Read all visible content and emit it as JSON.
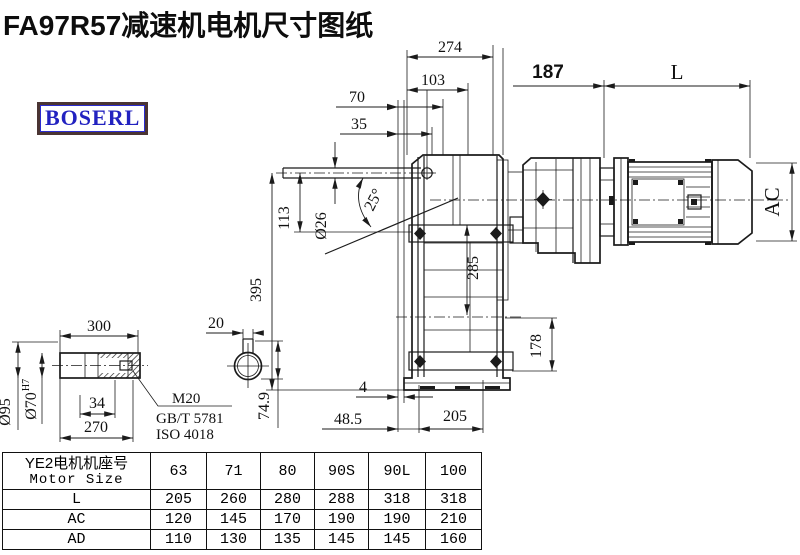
{
  "title": "FA97R57减速机电机尺寸图纸",
  "logo": {
    "text": "BOSERL",
    "text_color": "#2222c0",
    "border_outer": "#4a3433",
    "border_inner": "#2b2bd0"
  },
  "drawing": {
    "line_color": "#1b1b1b",
    "dims": {
      "d274": "274",
      "d103": "103",
      "d70": "70",
      "d35": "35",
      "d187": "187",
      "dL": "L",
      "angle25": "25°",
      "dia26": "Ø26",
      "d113": "113",
      "d395": "395",
      "d285": "285",
      "d178": "178",
      "dAC": "AC",
      "d4": "4",
      "d48_5": "48.5",
      "d205": "205",
      "d300": "300",
      "d20": "20",
      "dia95": "Ø95",
      "dia70": "Ø70",
      "tol70": "H7",
      "d34": "34",
      "d270": "270",
      "d74_9": "74.9",
      "m20": "M20",
      "gb": "GB/T 5781",
      "iso": "ISO 4018"
    }
  },
  "table": {
    "header_col1_line1": "YE2电机机座号",
    "header_col1_line2": "Motor Size",
    "sizes": [
      "63",
      "71",
      "80",
      "90S",
      "90L",
      "100"
    ],
    "rows": [
      {
        "label": "L",
        "values": [
          "205",
          "260",
          "280",
          "288",
          "318",
          "318"
        ]
      },
      {
        "label": "AC",
        "values": [
          "120",
          "145",
          "170",
          "190",
          "190",
          "210"
        ]
      },
      {
        "label": "AD",
        "values": [
          "110",
          "130",
          "135",
          "145",
          "145",
          "160"
        ]
      }
    ]
  }
}
